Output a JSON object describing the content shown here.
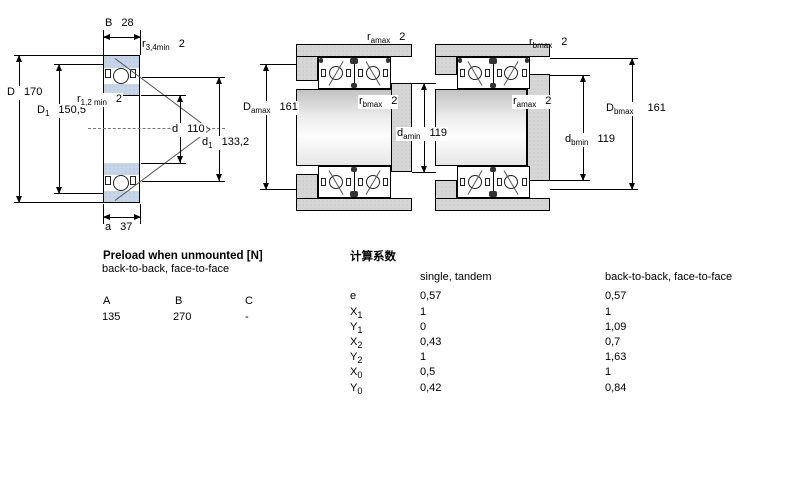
{
  "colors": {
    "ring_blue": "#c6d5e8",
    "housing_gray": "#d6d6d6",
    "line_black": "#000000"
  },
  "single_bearing": {
    "width": {
      "sym": "B",
      "sub": "",
      "val": "28"
    },
    "r_outer": {
      "sym": "r",
      "sub": "3,4min",
      "val": "2"
    },
    "outer_dia": {
      "sym": "D",
      "sub": "",
      "val": "170"
    },
    "outer_shoulder": {
      "sym": "D",
      "sub": "1",
      "val": "150,5"
    },
    "r_inner": {
      "sym": "r",
      "sub": "1,2 min",
      "val": "2"
    },
    "bore": {
      "sym": "d",
      "sub": "",
      "val": "110"
    },
    "inner_shoulder": {
      "sym": "d",
      "sub": "1",
      "val": "133,2"
    },
    "load_center": {
      "sym": "a",
      "sub": "",
      "val": "37"
    }
  },
  "mounted_back_to_back": {
    "r_a": {
      "sym": "r",
      "sub": "amax",
      "val": "2"
    },
    "r_b": {
      "sym": "r",
      "sub": "bmax",
      "val": "2"
    },
    "housing_shoulder": {
      "sym": "D",
      "sub": "amax",
      "val": "161"
    },
    "shaft_shoulder": {
      "sym": "d",
      "sub": "amin",
      "val": "119"
    }
  },
  "mounted_face_to_face": {
    "r_b": {
      "sym": "r",
      "sub": "bmax",
      "val": "2"
    },
    "r_a": {
      "sym": "r",
      "sub": "amax",
      "val": "2"
    },
    "shaft_shoulder": {
      "sym": "d",
      "sub": "bmin",
      "val": "119"
    },
    "housing_shoulder": {
      "sym": "D",
      "sub": "bmax",
      "val": "161"
    }
  },
  "preload": {
    "title": "Preload when unmounted [N]",
    "subtitle": "back-to-back, face-to-face",
    "col_a": "A",
    "col_b": "B",
    "col_c": "C",
    "val_a": "135",
    "val_b": "270",
    "val_c": "-"
  },
  "factors": {
    "title": "计算系数",
    "single_header": "single, tandem",
    "paired_header": "back-to-back, face-to-face",
    "rows": [
      {
        "sym": "e",
        "sub": "",
        "single": "0,57",
        "paired": "0,57"
      },
      {
        "sym": "X",
        "sub": "1",
        "single": "1",
        "paired": "1"
      },
      {
        "sym": "Y",
        "sub": "1",
        "single": "0",
        "paired": "1,09"
      },
      {
        "sym": "X",
        "sub": "2",
        "single": "0,43",
        "paired": "0,7"
      },
      {
        "sym": "Y",
        "sub": "2",
        "single": "1",
        "paired": "1,63"
      },
      {
        "sym": "X",
        "sub": "0",
        "single": "0,5",
        "paired": "1"
      },
      {
        "sym": "Y",
        "sub": "0",
        "single": "0,42",
        "paired": "0,84"
      }
    ]
  }
}
